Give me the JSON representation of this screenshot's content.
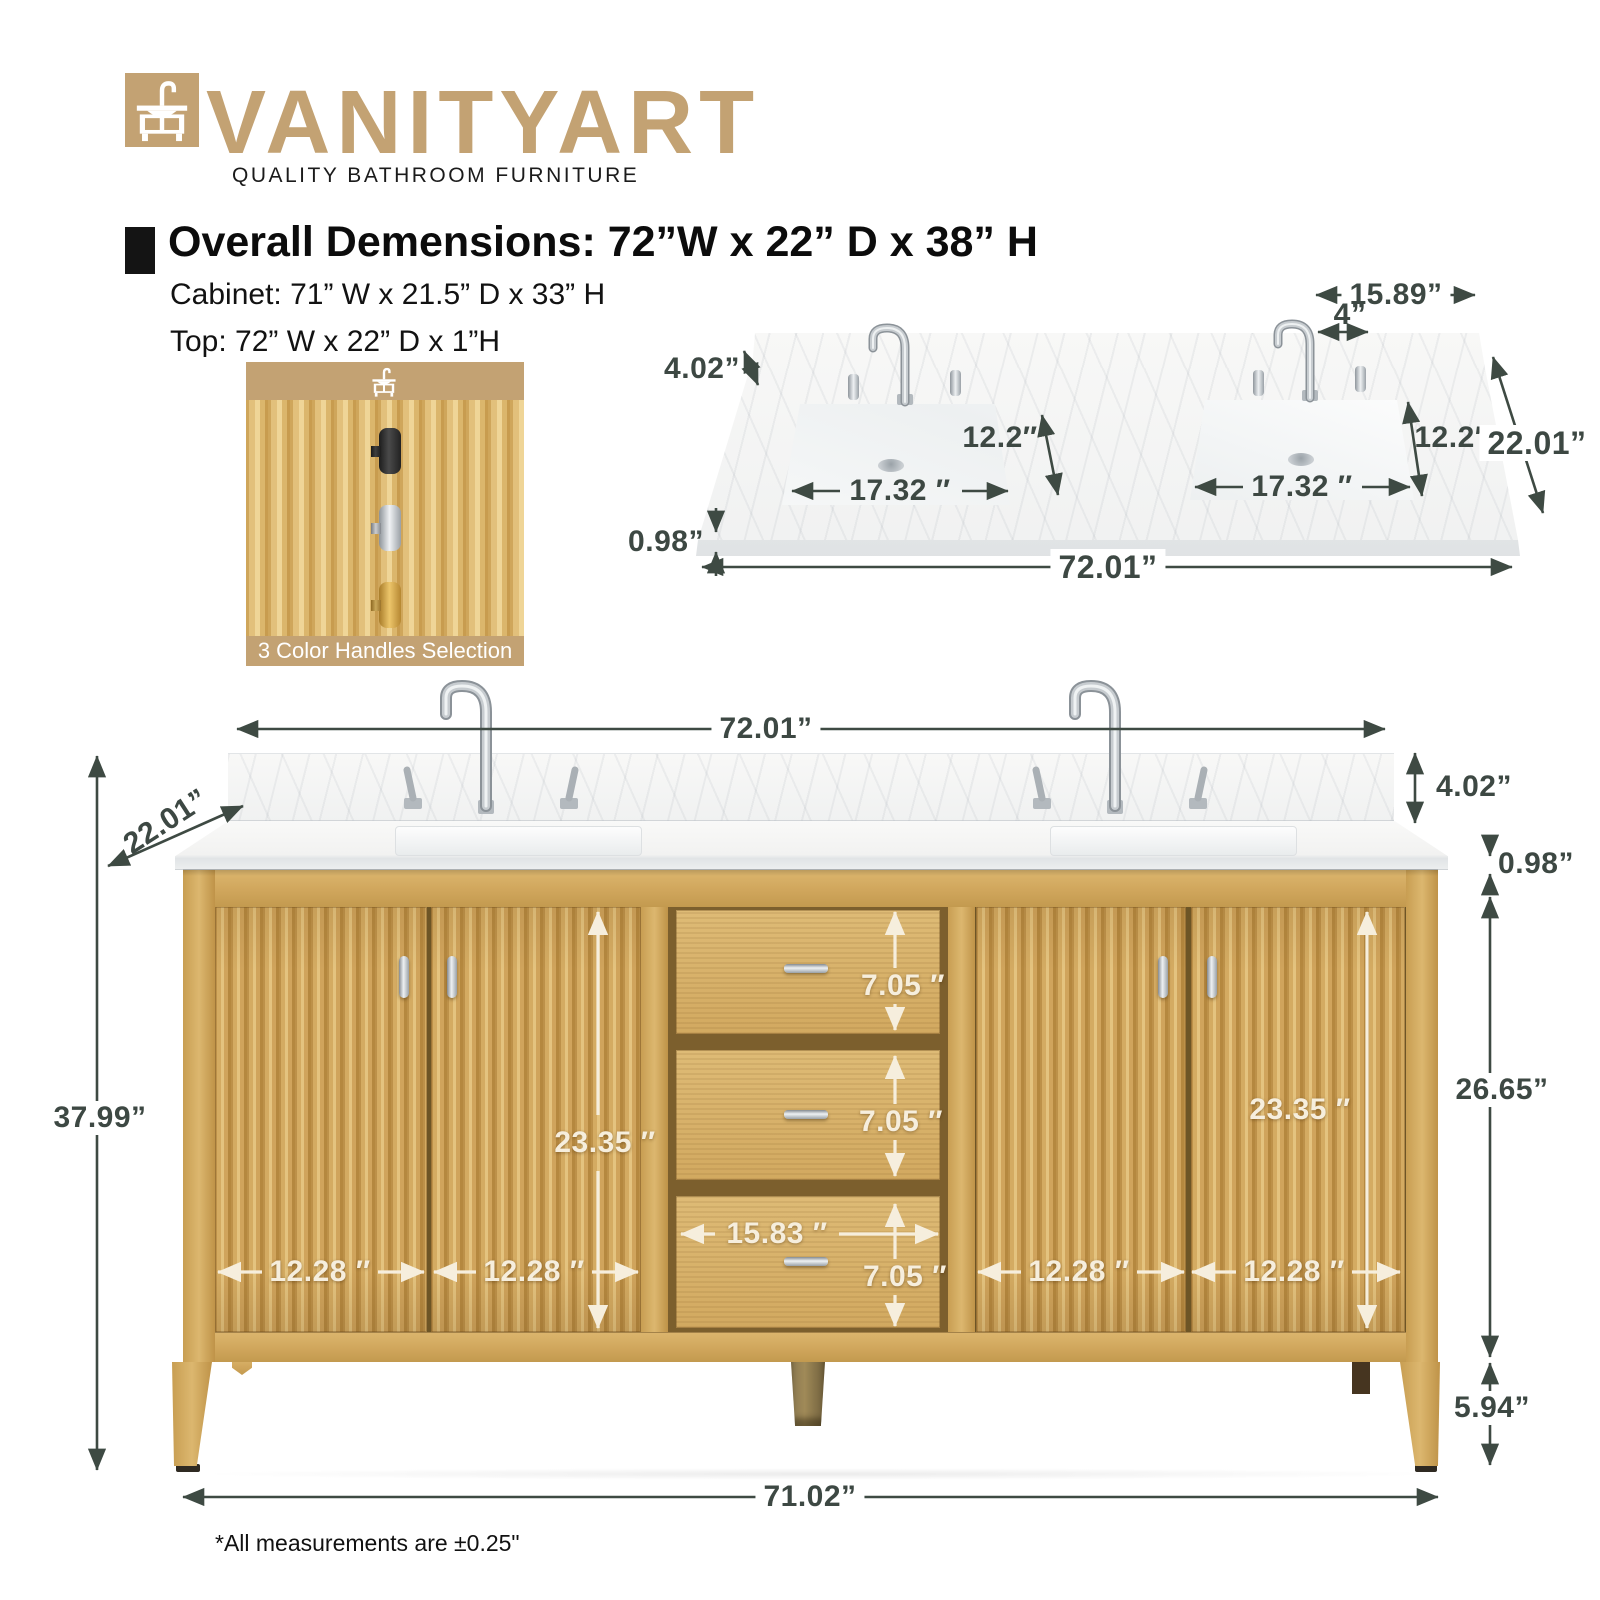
{
  "brand": {
    "name": "VANITYART",
    "tagline": "QUALITY BATHROOM FURNITURE"
  },
  "specs": {
    "title": "Overall Demensions: 72”W x 22” D x 38” H",
    "cabinet_line": "Cabinet: 71” W x 21.5” D x 33” H",
    "top_line": "Top: 72” W x 22” D x 1”H"
  },
  "handles_card": {
    "caption": "3 Color Handles Selection",
    "options": [
      "black",
      "chrome",
      "gold"
    ]
  },
  "top_view": {
    "backsplash_right_section_width": "15.89”",
    "faucet_hole_spread": "4”",
    "backsplash_height": "4.02”",
    "left_sink_depth": "12.2″",
    "right_sink_depth": "12.2″",
    "countertop_depth": "22.01”",
    "left_sink_width": "17.32 ″",
    "right_sink_width": "17.32 ″",
    "countertop_thickness": "0.98”",
    "countertop_width": "72.01”"
  },
  "front_view": {
    "countertop_width": "72.01”",
    "countertop_depth": "22.01”",
    "backsplash_height": "4.02”",
    "countertop_thickness": "0.98”",
    "overall_height": "37.99”",
    "left_door_height": "23.35 ″",
    "right_door_height": "23.35 ″",
    "drawer_heights": [
      "7.05 ″",
      "7.05 ″",
      "7.05 ″"
    ],
    "drawer_width": "15.83 ″",
    "door_widths": [
      "12.28 ″",
      "12.28 ″",
      "12.28 ″",
      "12.28 ″"
    ],
    "cabinet_body_height": "26.65”",
    "leg_height": "5.94”",
    "cabinet_base_width": "71.02”"
  },
  "footnote": "*All measurements are ±0.25\"",
  "colors": {
    "brand_tan": "#c3a273",
    "dimension_text": "#3d4843",
    "cabinet_wood": "#d2a75f",
    "cabinet_label_text": "#f6eedd"
  }
}
